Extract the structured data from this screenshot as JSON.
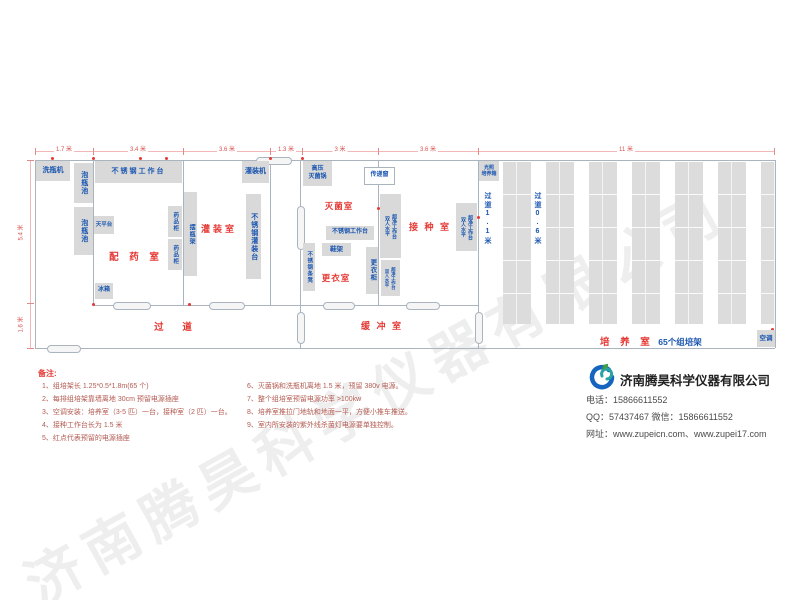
{
  "colors": {
    "room_label_red": "#e53935",
    "equipment_blue": "#1a56b0",
    "box_gray": "#d9d9d9",
    "wall_gray": "#a9b4bf",
    "dimension_red": "#d9534f",
    "note_red": "#b35b52"
  },
  "plan": {
    "dims_top": [
      "1.7 米",
      "3.4 米",
      "3.6 米",
      "1.3 米",
      "3 米",
      "3.6 米",
      "11 米"
    ],
    "dims_left": [
      "5.4 米",
      "1.6 米"
    ],
    "rooms": {
      "peiyao": "配 药 室",
      "guanzhuang": "灌装室",
      "miejun": "灭菌室",
      "jiezhong": "接 种 室",
      "gengyi": "更衣室",
      "huanchong": "缓 冲 室",
      "guodao": "过    道",
      "peiyang": "培 养 室",
      "peiyang_extra": "65个组培架"
    },
    "corridors": {
      "c1": "过道1.1米",
      "c2": "过道0.6米"
    },
    "eq": {
      "washer": "洗瓶机",
      "soak": "泡瓶池",
      "worktable": "不锈钢工作台",
      "balance": "天平台",
      "fridge": "冰箱",
      "med_cabinet": "药品柜",
      "bottle_rack": "摆瓶架",
      "filler": "灌装机",
      "filling_table": "不锈钢灌装台",
      "autoclave_l1": "高压",
      "autoclave_l2": "灭菌锅",
      "pass_window": "传递窗",
      "bench_l1": "双人水平",
      "bench_l2": "超净工作台",
      "shoe_rack": "鞋架",
      "steel_bench": "不锈钢条凳",
      "locker": "更衣柜",
      "incubator_l1": "光照",
      "incubator_l2": "培养箱",
      "ac": "空调"
    }
  },
  "notes": {
    "heading": "备注:",
    "col1": [
      "1、组培架长 1.25*0.5*1.8m(65 个)",
      "2、每排组培架靠墙离地 30cm 预留电源插座",
      "3、空调安装：培养室（3-5 匹）一台，接种室（2 匹）一台。",
      "4、接种工作台长为 1.5 米",
      "5、红点代表预留的电源插座"
    ],
    "col2": [
      "6、灭菌锅和洗瓶机离地 1.5 米，预留 380v 电源。",
      "7、整个组培室预留电源功率 >100kw",
      "8、培养室推拉门地轨和地面一平，方便小推车推送。",
      "9、室内所安装的紫外线杀菌灯电源要单独控制。"
    ]
  },
  "company": {
    "name": "济南腾昊科学仪器有限公司",
    "phone": "电话：15866611552",
    "qq_wechat": "QQ：57437467    微信：15866611552",
    "web": "网址：www.zupeicn.com、www.zupei17.com"
  },
  "watermark": {
    "text": "济南腾昊科学仪器有限公司"
  }
}
